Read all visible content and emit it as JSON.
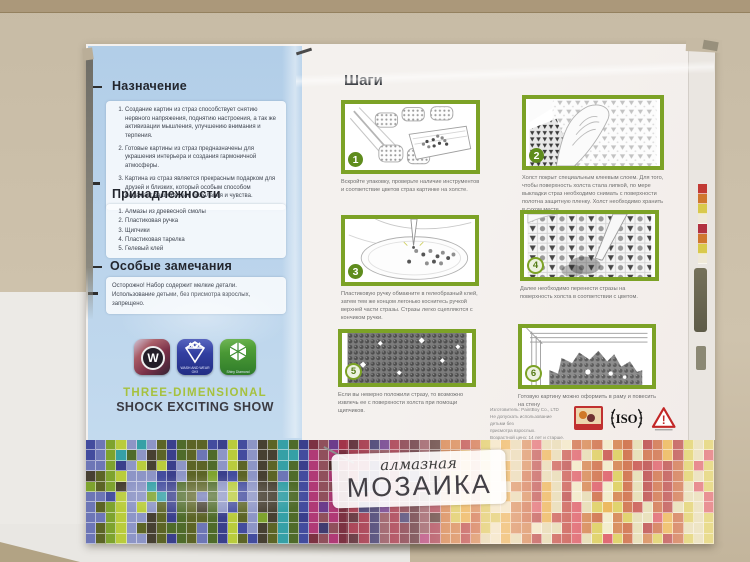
{
  "left_panel": {
    "purpose": {
      "title": "Назначение",
      "items": [
        "Создание картин из страз способствует снятию нервного напряжения, поднятию настроения, а так же активизации мышления, улучшению внимания и терпения.",
        "Готовые картины из страз предназначены для украшения интерьера и создания гармоничной атмосферы.",
        "Картина из страз является прекрасным подарком для друзей и близких, который особым способом выражает ваши теплые пожелания и чувства."
      ]
    },
    "accessories": {
      "title": "Принадлежности",
      "items": [
        "Алмазы из древесной смолы",
        "Пластиковая ручка",
        "Щипчики",
        "Пластиковая тарелка",
        "Гелевый клей"
      ]
    },
    "notes": {
      "title": "Особые замечания",
      "text": "Осторожно! Набор содержит мелкие детали. Использование детьми, без присмотра взрослых, запрещено."
    },
    "badges": {
      "w_letter": "W",
      "no1_label": "NO.1",
      "no1_caption": "WASH AND WEAR OK!!",
      "shiny_caption": "Shiny Diamond"
    },
    "slogan1": "THREE-DIMENSIONAL",
    "slogan2": "SHOCK EXCITING SHOW"
  },
  "steps": {
    "title": "Шаги",
    "items": [
      {
        "n": "1",
        "caption": "Вскройте упаковку, проверьте наличие инструментов и соответствие цветов страз картинке на холсте."
      },
      {
        "n": "2",
        "caption": "Холст покрыт специальным клеевым слоем. Для того, чтобы поверхность холста стала липкой, по мере выкладки страз необходимо снимать с поверхности полотна защитную пленку. Холст необходимо хранить в сухом месте."
      },
      {
        "n": "3",
        "caption": "Пластиковую ручку обмакните в гелеобразный клей, затем тем же концом легонько коснитесь ручкой верхней части стразы. Стразы легко сцепляются с кончиком ручки."
      },
      {
        "n": "4",
        "caption": "Далее необходимо перенести стразы на поверхность холста в соответствии с цветом."
      },
      {
        "n": "5",
        "caption": "Если вы неверно положили стразу, то возможно извлечь ее с поверхности холста при помощи щипчиков."
      },
      {
        "n": "6",
        "caption": "Готовую картину можно оформить в раму и повесить на стену"
      }
    ]
  },
  "footer": {
    "lines": [
      "Изготовитель: PaintBoy Co., LTD",
      "Не допускать использование детьми без",
      "присмотра взрослых.",
      "Возрастной ценз: 14 лет и старше."
    ],
    "iso": "ISO",
    "warning_mark": "!"
  },
  "brand": {
    "script": "алмазная",
    "main": "МОЗАИКА"
  },
  "colors": {
    "accent_green": "#7ca226",
    "panel_blue": "#b7d1e8",
    "slogan_green": "#a6c13e"
  },
  "mosaic": {
    "cols": 62,
    "rows": 10,
    "zones": [
      {
        "until": 0.34,
        "colors": [
          "#434c9e",
          "#3a3f8c",
          "#6d76b6",
          "#7ea32e",
          "#b9cc3c",
          "#5c6426",
          "#474032",
          "#35a0a6",
          "#8d95c6",
          "#4f6b2a"
        ]
      },
      {
        "until": 0.56,
        "colors": [
          "#5c2c36",
          "#7c3242",
          "#a23449",
          "#b03a76",
          "#6c3c8c",
          "#4c2c2a",
          "#90505c",
          "#403c70"
        ]
      },
      {
        "until": 1.01,
        "colors": [
          "#c14038",
          "#d0773c",
          "#d9c94c",
          "#e2d9aa",
          "#c85c30",
          "#b23232",
          "#e8aa3a",
          "#f0e9c2",
          "#d94a56"
        ]
      }
    ],
    "side_chips": [
      "#c23a34",
      "#d0772f",
      "#d9c94c",
      "#efe9d8",
      "#b23240",
      "#d0772f",
      "#d9c94c",
      "#efe9d8"
    ]
  }
}
